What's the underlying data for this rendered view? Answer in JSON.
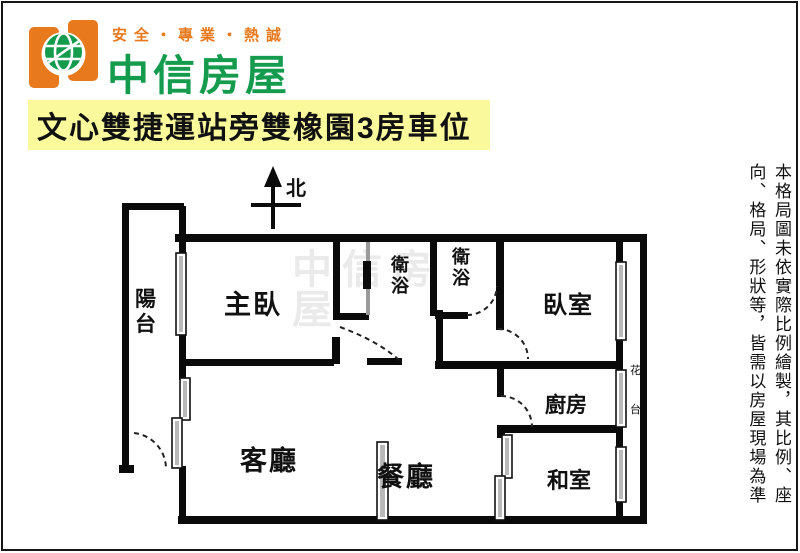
{
  "brand": {
    "slogan": "安全・專業・熱誠",
    "name": "中信房屋"
  },
  "title": "文心雙捷運站旁雙橡園3房車位",
  "compass": {
    "north_label": "北"
  },
  "floorplan": {
    "rooms": {
      "balcony": "陽台",
      "master_bedroom": "主臥",
      "bathroom1": "衛浴",
      "bathroom2": "衛浴",
      "bedroom": "臥室",
      "flower_bed": "花台",
      "kitchen": "廚房",
      "living_room": "客廳",
      "dining_room": "餐廳",
      "tatami_room": "和室"
    },
    "watermark": "中信房屋"
  },
  "disclaimer": {
    "line1": "本格局圖未依實際比例繪製，其比例、座",
    "line2": "向、格局、形狀等，皆需以房屋現場為準"
  },
  "colors": {
    "brand_orange": "#E8791D",
    "brand_green": "#149B4D",
    "highlight_yellow": "#FAFA9C",
    "wall_black": "#0A0A0A",
    "window_gray": "#B9B9B9"
  }
}
